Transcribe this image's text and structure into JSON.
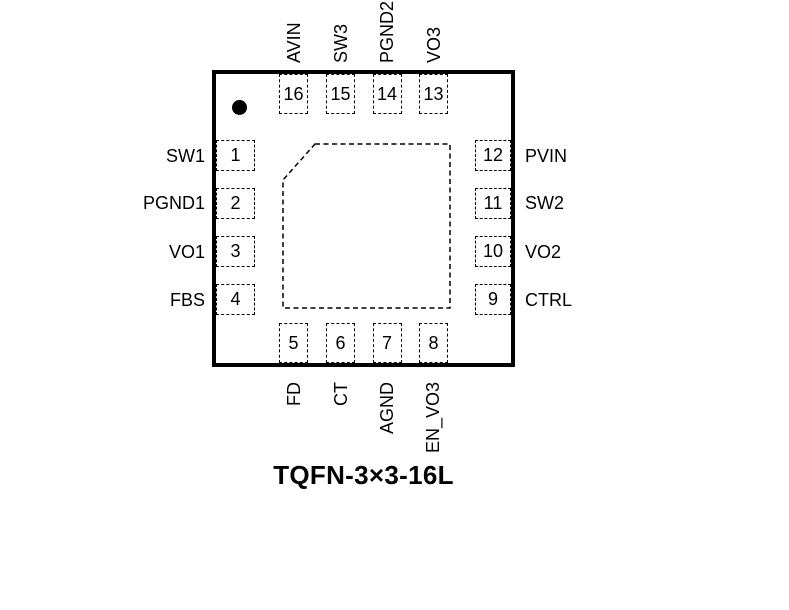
{
  "package": {
    "caption": "TQFN-3×3-16L",
    "type": "chip-pinout-diagram",
    "pin1_indicator": "filled-circle",
    "exposed_pad": "dashed-square-chamfered-top-left"
  },
  "colors": {
    "line": "#000000",
    "background": "#ffffff"
  },
  "pins": {
    "top": [
      {
        "number": "16",
        "name": "AVIN"
      },
      {
        "number": "15",
        "name": "SW3"
      },
      {
        "number": "14",
        "name": "PGND2"
      },
      {
        "number": "13",
        "name": "VO3"
      }
    ],
    "left": [
      {
        "number": "1",
        "name": "SW1"
      },
      {
        "number": "2",
        "name": "PGND1"
      },
      {
        "number": "3",
        "name": "VO1"
      },
      {
        "number": "4",
        "name": "FBS"
      }
    ],
    "right": [
      {
        "number": "12",
        "name": "PVIN"
      },
      {
        "number": "11",
        "name": "SW2"
      },
      {
        "number": "10",
        "name": "VO2"
      },
      {
        "number": "9",
        "name": "CTRL"
      }
    ],
    "bottom": [
      {
        "number": "5",
        "name": "FD"
      },
      {
        "number": "6",
        "name": "CT"
      },
      {
        "number": "7",
        "name": "AGND"
      },
      {
        "number": "8",
        "name": "EN_VO3"
      }
    ]
  }
}
